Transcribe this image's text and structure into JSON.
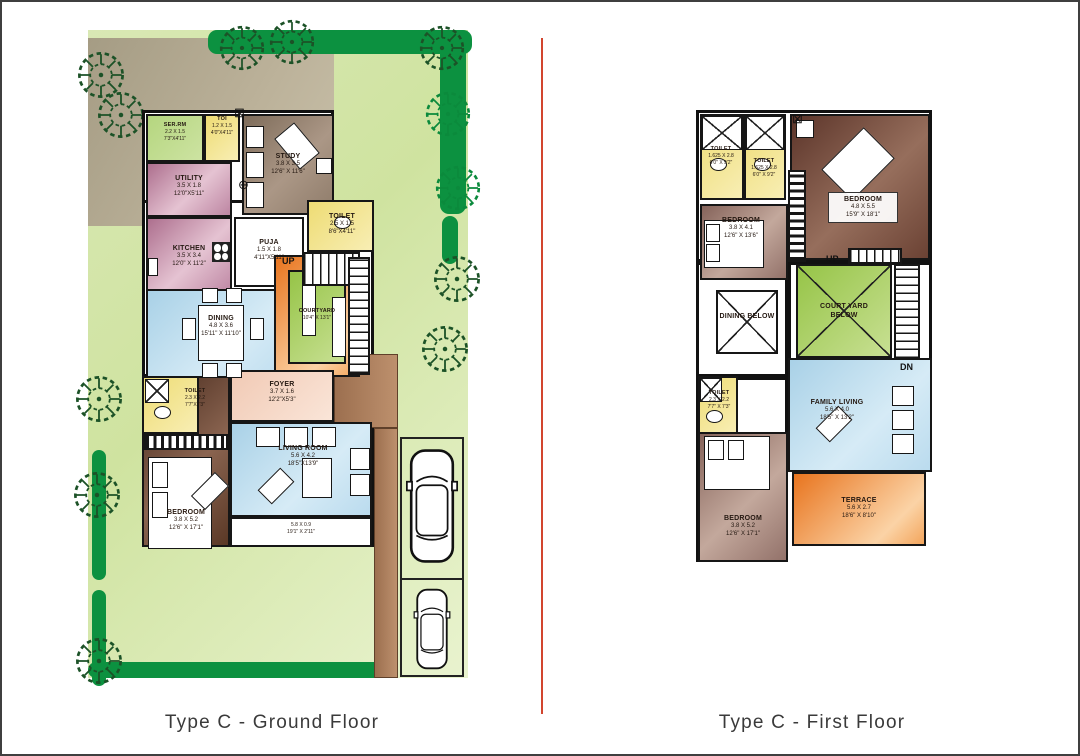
{
  "captions": {
    "ground": "Type C - Ground Floor",
    "first": "Type C - First Floor"
  },
  "icons": {
    "window_x": "⊠",
    "fan": "⊕"
  },
  "colors": {
    "divider": "#d2452e",
    "plot_green": "#cfe3a0",
    "hedge_green": "#0c9140",
    "courtyard_green": "#9cc84e",
    "terrace_orange": "#e8741e",
    "wall": "#161616"
  },
  "ground": {
    "serrm": {
      "name": "SER.RM",
      "m": "2.2 X 1.5",
      "ft": "7'3\"X4'11\""
    },
    "toi": {
      "name": "TOI",
      "m": "1.2 X 1.5",
      "ft": "4'0\"X4'11\""
    },
    "study": {
      "name": "STUDY",
      "m": "3.8 X 3.5",
      "ft": "12'6\" X 11'6\""
    },
    "utility": {
      "name": "UTILITY",
      "m": "3.5 X 1.8",
      "ft": "12'0\"X5'11\""
    },
    "kitchen": {
      "name": "KITCHEN",
      "m": "3.5 X 3.4",
      "ft": "12'0\" X 11'2\""
    },
    "puja": {
      "name": "PUJA",
      "m": "1.5 X 1.8",
      "ft": "4'11\"X5'11\""
    },
    "toilet_r": {
      "name": "TOILET",
      "m": "2.5 X 1.5",
      "ft": "8'6\"X4'11\""
    },
    "dining": {
      "name": "DINING",
      "m": "4.8 X 3.6",
      "ft": "15'11\" X 11'10\""
    },
    "courtyard": {
      "name": "COURTYARD",
      "ft": "10'4\" X 13'1\""
    },
    "toilet_bl": {
      "name": "TOILET",
      "m": "2.3 X 2.2",
      "ft": "7'7\"X7'3\""
    },
    "bedroom": {
      "name": "BEDROOM",
      "m": "3.8 X 5.2",
      "ft": "12'6\" X 17'1\""
    },
    "foyer": {
      "name": "FOYER",
      "m": "3.7 X 1.6",
      "ft": "12'2\"X5'3\""
    },
    "living": {
      "name": "LIVING ROOM",
      "m": "5.6 X 4.2",
      "ft": "18'5\"X13'9\""
    },
    "sitout": {
      "m": "5.8 X 0.9",
      "ft": "19'1\" X 2'11\""
    },
    "up": "UP"
  },
  "first": {
    "toilet_a": {
      "name": "TOILET",
      "m": "1.625 X 2.8",
      "ft": "6'0\" X 9'2\""
    },
    "toilet_b": {
      "name": "TOILET",
      "m": "1.625 X 2.8",
      "ft": "6'0\" X 9'2\""
    },
    "bedroom_tr": {
      "name": "BEDROOM",
      "m": "4.8 X 5.5",
      "ft": "15'9\" X 18'1\""
    },
    "bedroom_ml": {
      "name": "BEDROOM",
      "m": "3.8 X 4.1",
      "ft": "12'6\" X 13'6\""
    },
    "dining_below": {
      "name": "DINING BELOW"
    },
    "courtyard_below": {
      "name": "COURT YARD BELOW"
    },
    "toilet_c": {
      "name": "TOILET",
      "m": "2.3 X 2.2",
      "ft": "7'7\" X 7'3\""
    },
    "family": {
      "name": "FAMILY LIVING",
      "m": "5.6 X 4.0",
      "ft": "18'5\" X 13'2\""
    },
    "bedroom_b": {
      "name": "BEDROOM",
      "m": "3.8 X 5.2",
      "ft": "12'6\" X 17'1\""
    },
    "terrace": {
      "name": "TERRACE",
      "m": "5.6 X 2.7",
      "ft": "18'6\" X 8'10\""
    },
    "up": "UP",
    "dn": "DN"
  }
}
